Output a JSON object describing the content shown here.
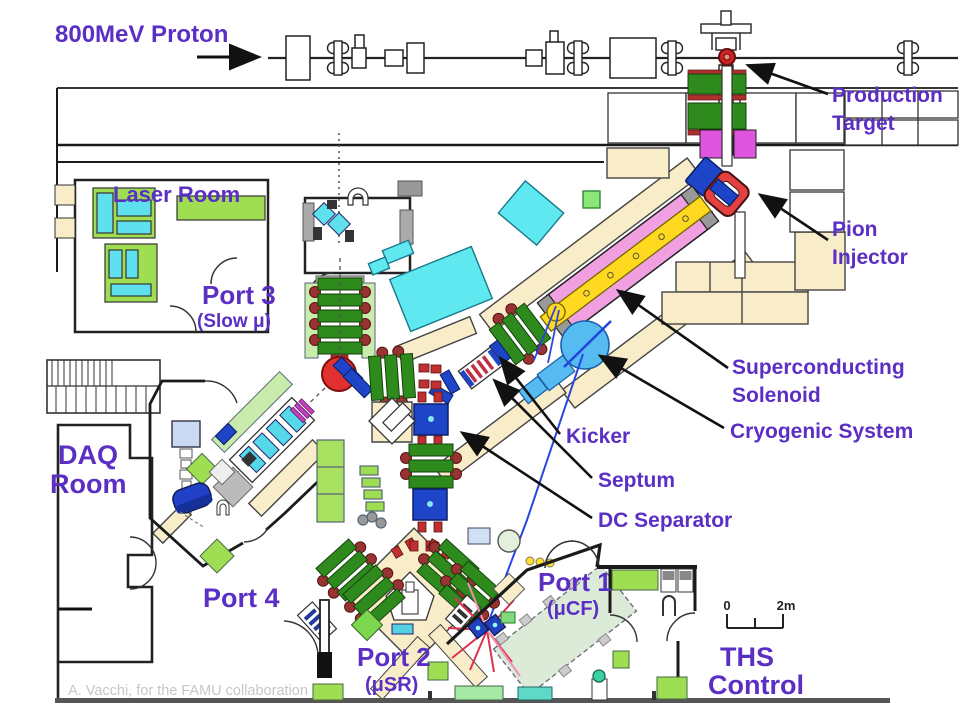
{
  "labels": {
    "proton": "800MeV Proton",
    "production_target_1": "Production",
    "production_target_2": "Target",
    "pion_injector_1": "Pion",
    "pion_injector_2": "Injector",
    "solenoid_1": "Superconducting",
    "solenoid_2": "Solenoid",
    "kicker": "Kicker",
    "cryogenic": "Cryogenic System",
    "septum": "Septum",
    "dc_separator": "DC Separator",
    "laser_room": "Laser Room",
    "port3": "Port 3",
    "port3_sub": "(Slow μ)",
    "daq_1": "DAQ",
    "daq_2": "Room",
    "port4": "Port 4",
    "port1": "Port 1",
    "port1_sub": "(μCF)",
    "port2": "Port 2",
    "port2_sub": "(μSR)",
    "ths_1": "THS",
    "ths_2": "Control"
  },
  "scale_bar": {
    "start": "0",
    "end": "2m"
  },
  "watermark": "A. Vacchi, for the FAMU collaboration",
  "colors": {
    "label_purple": "#5B2FC4",
    "wall_beige": "#F8EDC8",
    "magnet_green": "#2F8A1E",
    "coil_red": "#A03030",
    "device_blue": "#1E44C8",
    "detector_cyan": "#5FE0EE",
    "room_green": "#9FDE53",
    "pale_green": "#C9ECAD",
    "solenoid_pink": "#F0A0E0",
    "solenoid_yellow": "#FFD920",
    "target_magenta": "#E055E0",
    "cryo_blue": "#55BBF0",
    "dipole_red": "#E03030"
  }
}
